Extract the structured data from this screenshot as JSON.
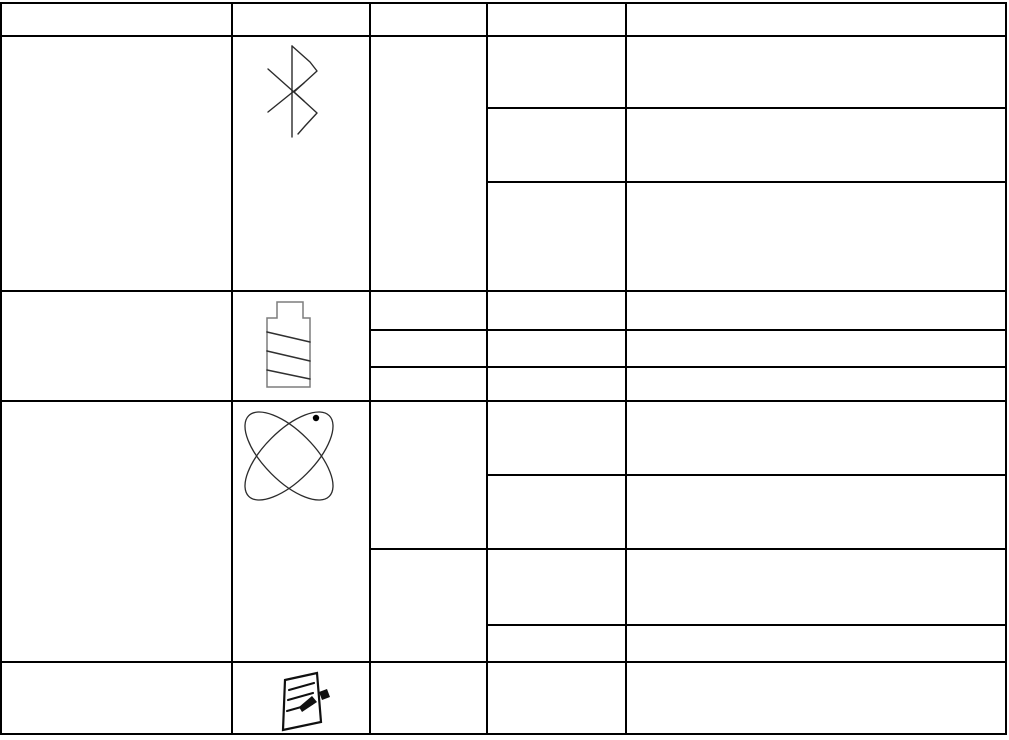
{
  "page": {
    "background": "#ffffff",
    "line_color": "#000000",
    "all_cells_empty": true
  },
  "table": {
    "columns": 5,
    "header_row": {
      "text": ""
    },
    "rows": [
      {
        "name": "bluetooth-row",
        "icon": "bluetooth",
        "detail_subrows": 3
      },
      {
        "name": "battery-row",
        "icon": "battery",
        "detail_subrows": 3
      },
      {
        "name": "atom-row",
        "icon": "atom",
        "detail_subrows": 4
      },
      {
        "name": "note-row",
        "icon": "note",
        "detail_subrows": 1
      }
    ]
  },
  "icons": {
    "bluetooth": {
      "label": "bluetooth-icon",
      "color": "#2b2b2b"
    },
    "battery": {
      "label": "battery-icon",
      "outline_color": "#7d7d7d",
      "stripe_color": "#303030"
    },
    "atom": {
      "label": "atom-icon",
      "color": "#2b2b2b",
      "dot_color": "#000000"
    },
    "note": {
      "label": "note-icon",
      "color": "#101010"
    }
  }
}
